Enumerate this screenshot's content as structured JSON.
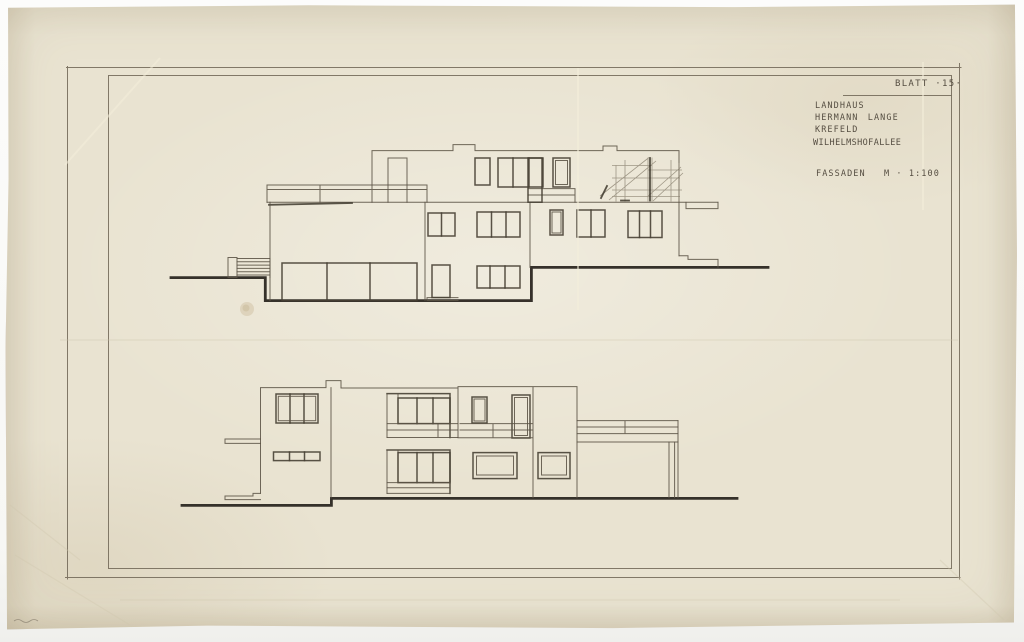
{
  "sheet": {
    "blatt_label": "BLATT ·15·",
    "project": {
      "line1": "LANDHAUS",
      "line2": "HERMANN LANGE",
      "line3": "KREFELD",
      "line4": "WILHELMSHOFALLEE"
    },
    "drawing_type_label": "FASSADEN",
    "scale_label": "M · 1:100",
    "colors": {
      "paper": "#e9e3d1",
      "background": "#fbfbf9",
      "line": "#5b5345",
      "heavy_line": "#2b2721",
      "text": "#4a4237"
    }
  }
}
